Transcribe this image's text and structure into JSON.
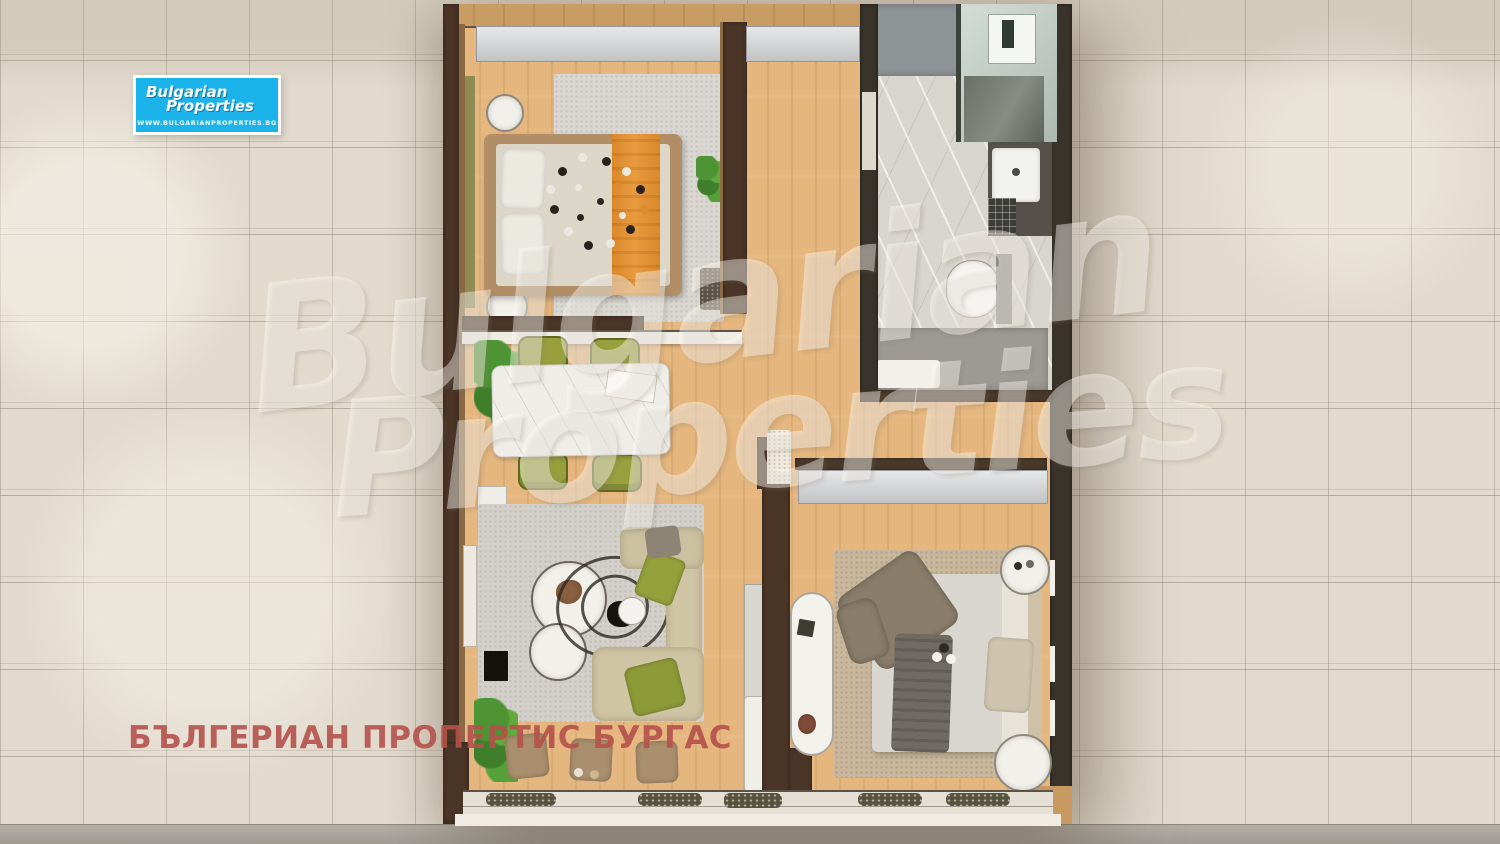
{
  "logo": {
    "line1": "Bulgarian",
    "line2": "Properties",
    "website": "WWW.BULGARIANPROPERTIES.BG",
    "background_color": "#1cb3ea",
    "text_color": "#ffffff"
  },
  "watermark": {
    "word1": "Bulgarian",
    "word2": "Properties",
    "color": "rgba(255,253,248,0.42)"
  },
  "caption": {
    "text": "БЪЛГЕРИАН ПРОПЕРТИС БУРГАС",
    "color": "#b5514c"
  },
  "palette": {
    "tile_background": "#e2dacd",
    "tile_grout": "#b3a894",
    "concrete_strip": "#a8a49c",
    "wood_floor": "#e5b67e",
    "wall_dark_brown": "#4a3526",
    "wardrobe_gray": "#cdcfd1",
    "bed_blanket_orange": "#e0912f",
    "dining_chair_olive": "#97a03d",
    "sofa_beige": "#cfc5a5",
    "marble_light": "#d8d4ce"
  }
}
